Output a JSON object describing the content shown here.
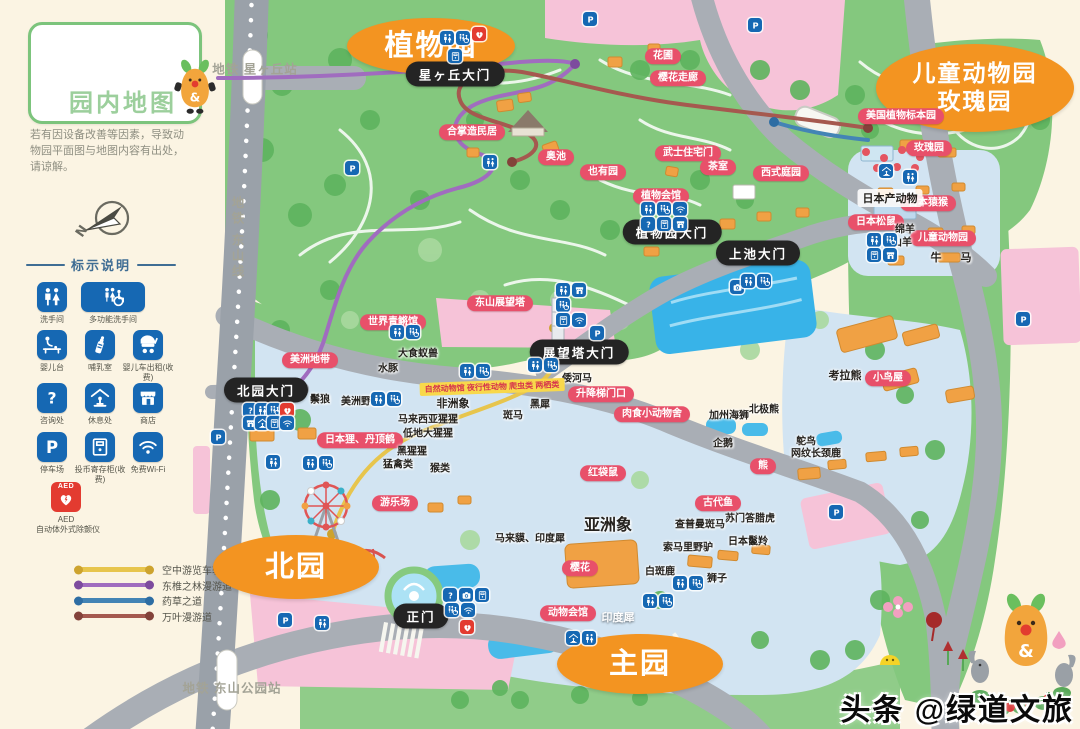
{
  "title_card": {
    "title": "园内地图",
    "mascot_text": "&"
  },
  "disclaimer": "若有因设备改善等因素，导致动物园平面图与地图内容有出处，请谅解。",
  "compass": {
    "letter": "N"
  },
  "legend": {
    "title": "标示说明",
    "items": [
      {
        "icon": "toilet",
        "name": "restroom-icon",
        "label": "洗手间"
      },
      {
        "icon": "acc",
        "name": "accessible-restroom-icon",
        "label": "多功能洗手间",
        "wide": true
      },
      {
        "icon": "baby",
        "name": "baby-changing-icon",
        "label": "婴儿台"
      },
      {
        "icon": "bottle",
        "name": "nursing-room-icon",
        "label": "哺乳室"
      },
      {
        "icon": "stroller",
        "name": "stroller-rental-icon",
        "label": "婴儿车出租(收费)"
      },
      {
        "icon": "q",
        "name": "information-icon",
        "label": "咨询处"
      },
      {
        "icon": "rest",
        "name": "rest-area-icon",
        "label": "休息处"
      },
      {
        "icon": "shop",
        "name": "shop-icon",
        "label": "商店"
      },
      {
        "icon": "park",
        "name": "parking-icon",
        "label": "停车场"
      },
      {
        "icon": "locker",
        "name": "coin-locker-icon",
        "label": "投币寄存柜(收费)"
      },
      {
        "icon": "wifi",
        "name": "free-wifi-icon",
        "label": "免费Wi-Fi"
      }
    ],
    "aed": {
      "label": "AED",
      "caption": "AED",
      "sub": "自动体外式除颤仪"
    }
  },
  "route_legend": [
    {
      "color": "#e7c54d",
      "dot": "#cda32e",
      "label": "空中游览车轨道"
    },
    {
      "color": "#a06cbf",
      "dot": "#7d4b9e",
      "label": "东椎之林漫游道"
    },
    {
      "color": "#4384b5",
      "dot": "#2d6da3",
      "label": "药草之道"
    },
    {
      "color": "#a5594f",
      "dot": "#83423a",
      "label": "万叶漫游道"
    }
  ],
  "map": {
    "stations": [
      {
        "text": "地铁 星ヶ丘站",
        "x": 255,
        "y": 68,
        "vertical": false
      },
      {
        "text": "地铁 东山线",
        "x": 237,
        "y": 238,
        "vertical": true
      },
      {
        "text": "地铁 东山公园站",
        "x": 232,
        "y": 687,
        "vertical": false
      }
    ],
    "area_badges": [
      {
        "text": "植物园",
        "x": 431,
        "y": 46,
        "w": 168,
        "h": 56,
        "fs": 29
      },
      {
        "text": "儿童动物园\n玫瑰园",
        "x": 975,
        "y": 88,
        "w": 198,
        "h": 88,
        "fs": 23
      },
      {
        "text": "北园",
        "x": 296,
        "y": 567,
        "w": 166,
        "h": 64,
        "fs": 29
      },
      {
        "text": "主园",
        "x": 640,
        "y": 664,
        "w": 166,
        "h": 60,
        "fs": 29
      }
    ],
    "gates": [
      {
        "text": "星ヶ丘大门",
        "x": 455,
        "y": 74
      },
      {
        "text": "植物园大门",
        "x": 672,
        "y": 232
      },
      {
        "text": "上池大门",
        "x": 758,
        "y": 253
      },
      {
        "text": "展望塔大门",
        "x": 579,
        "y": 352
      },
      {
        "text": "北园大门",
        "x": 266,
        "y": 390
      },
      {
        "text": "正门",
        "x": 421,
        "y": 616
      }
    ],
    "pills": [
      {
        "text": "花圃",
        "x": 663,
        "y": 56
      },
      {
        "text": "樱花走廊",
        "x": 678,
        "y": 78
      },
      {
        "text": "合掌造民居",
        "x": 472,
        "y": 132
      },
      {
        "text": "奥池",
        "x": 556,
        "y": 157
      },
      {
        "text": "也有园",
        "x": 603,
        "y": 172
      },
      {
        "text": "武士住宅门",
        "x": 688,
        "y": 153
      },
      {
        "text": "茶室",
        "x": 718,
        "y": 167
      },
      {
        "text": "西式庭园",
        "x": 781,
        "y": 173
      },
      {
        "text": "植物会馆",
        "x": 661,
        "y": 196
      },
      {
        "text": "美国植物标本园",
        "x": 901,
        "y": 116
      },
      {
        "text": "玫瑰园",
        "x": 929,
        "y": 148
      },
      {
        "text": "日本猿猴",
        "x": 928,
        "y": 203
      },
      {
        "text": "日本松鼠",
        "x": 876,
        "y": 222
      },
      {
        "text": "儿童动物园",
        "x": 943,
        "y": 238
      },
      {
        "text": "东山展望塔",
        "x": 500,
        "y": 303
      },
      {
        "text": "世界青鳉馆",
        "x": 393,
        "y": 322
      },
      {
        "text": "美洲地带",
        "x": 310,
        "y": 360
      },
      {
        "text": "升降梯门口",
        "x": 601,
        "y": 394
      },
      {
        "text": "肉食小动物舍",
        "x": 652,
        "y": 414
      },
      {
        "text": "日本狸、丹顶鹤",
        "x": 360,
        "y": 440
      },
      {
        "text": "游乐场",
        "x": 395,
        "y": 503
      },
      {
        "text": "红袋鼠",
        "x": 603,
        "y": 473
      },
      {
        "text": "熊",
        "x": 763,
        "y": 466
      },
      {
        "text": "古代鱼",
        "x": 718,
        "y": 503
      },
      {
        "text": "樱花",
        "x": 580,
        "y": 568
      },
      {
        "text": "动物会馆",
        "x": 568,
        "y": 613
      },
      {
        "text": "小鸟屋",
        "x": 888,
        "y": 378
      }
    ],
    "labels": [
      {
        "text": "大食蚁兽",
        "x": 418,
        "y": 352
      },
      {
        "text": "水豚",
        "x": 388,
        "y": 367
      },
      {
        "text": "倭河马",
        "x": 577,
        "y": 377
      },
      {
        "text": "鬃狼",
        "x": 320,
        "y": 398
      },
      {
        "text": "美洲野牛",
        "x": 361,
        "y": 400
      },
      {
        "text": "非洲象",
        "x": 453,
        "y": 403,
        "fs": 11
      },
      {
        "text": "黑犀",
        "x": 540,
        "y": 403
      },
      {
        "text": "斑马",
        "x": 513,
        "y": 414
      },
      {
        "text": "马来西亚猩猩",
        "x": 428,
        "y": 418
      },
      {
        "text": "低地大猩猩",
        "x": 428,
        "y": 432
      },
      {
        "text": "黑猩猩",
        "x": 412,
        "y": 450
      },
      {
        "text": "猛禽类",
        "x": 398,
        "y": 463
      },
      {
        "text": "猴类",
        "x": 440,
        "y": 467
      },
      {
        "text": "日本产动物",
        "x": 890,
        "y": 198,
        "fs": 11,
        "boxed": true
      },
      {
        "text": "绵羊",
        "x": 905,
        "y": 228
      },
      {
        "text": "山羊",
        "x": 902,
        "y": 241
      },
      {
        "text": "牛",
        "x": 936,
        "y": 257,
        "fs": 11
      },
      {
        "text": "马",
        "x": 966,
        "y": 257,
        "fs": 11
      },
      {
        "text": "考拉熊",
        "x": 845,
        "y": 375,
        "fs": 11
      },
      {
        "text": "加州海狮",
        "x": 729,
        "y": 414
      },
      {
        "text": "北极熊",
        "x": 764,
        "y": 408
      },
      {
        "text": "企鹅",
        "x": 723,
        "y": 442
      },
      {
        "text": "鸵鸟",
        "x": 806,
        "y": 440
      },
      {
        "text": "网纹长颈鹿",
        "x": 816,
        "y": 452
      },
      {
        "text": "亚洲象",
        "x": 608,
        "y": 523,
        "fs": 16
      },
      {
        "text": "马来貘、印度犀",
        "x": 530,
        "y": 537
      },
      {
        "text": "苏门答腊虎",
        "x": 750,
        "y": 517
      },
      {
        "text": "查普曼斑马",
        "x": 700,
        "y": 523
      },
      {
        "text": "日本鬣羚",
        "x": 748,
        "y": 540
      },
      {
        "text": "索马里野驴",
        "x": 688,
        "y": 546
      },
      {
        "text": "白斑鹿",
        "x": 660,
        "y": 570
      },
      {
        "text": "狮子",
        "x": 717,
        "y": 577
      },
      {
        "text": "印度犀",
        "x": 618,
        "y": 617,
        "fs": 11,
        "white": true
      }
    ],
    "ribbon": {
      "text": "自然动物馆 夜行性动物 爬虫类 两栖类",
      "x": 492,
      "y": 387
    },
    "icons": [
      {
        "k": "toilet",
        "x": 447,
        "y": 38
      },
      {
        "k": "acc",
        "x": 463,
        "y": 38
      },
      {
        "k": "aed",
        "x": 479,
        "y": 34
      },
      {
        "k": "locker",
        "x": 455,
        "y": 56
      },
      {
        "k": "park",
        "x": 755,
        "y": 25
      },
      {
        "k": "park",
        "x": 590,
        "y": 19
      },
      {
        "k": "park",
        "x": 352,
        "y": 168
      },
      {
        "k": "toilet",
        "x": 490,
        "y": 162
      },
      {
        "k": "toilet",
        "x": 648,
        "y": 209
      },
      {
        "k": "acc",
        "x": 664,
        "y": 209
      },
      {
        "k": "wifi",
        "x": 680,
        "y": 209
      },
      {
        "k": "q",
        "x": 648,
        "y": 224
      },
      {
        "k": "locker",
        "x": 664,
        "y": 224
      },
      {
        "k": "shop",
        "x": 680,
        "y": 224
      },
      {
        "k": "toilet",
        "x": 563,
        "y": 290
      },
      {
        "k": "shop",
        "x": 579,
        "y": 290
      },
      {
        "k": "acc",
        "x": 563,
        "y": 305
      },
      {
        "k": "locker",
        "x": 563,
        "y": 320
      },
      {
        "k": "wifi",
        "x": 579,
        "y": 320
      },
      {
        "k": "park",
        "x": 597,
        "y": 333
      },
      {
        "k": "cam",
        "x": 737,
        "y": 287
      },
      {
        "k": "toilet",
        "x": 748,
        "y": 281
      },
      {
        "k": "acc",
        "x": 764,
        "y": 281
      },
      {
        "k": "rest",
        "x": 886,
        "y": 171
      },
      {
        "k": "toilet",
        "x": 910,
        "y": 177
      },
      {
        "k": "toilet",
        "x": 874,
        "y": 240
      },
      {
        "k": "acc",
        "x": 890,
        "y": 240
      },
      {
        "k": "locker",
        "x": 874,
        "y": 255
      },
      {
        "k": "shop",
        "x": 890,
        "y": 255
      },
      {
        "k": "park",
        "x": 1023,
        "y": 319
      },
      {
        "k": "toilet",
        "x": 397,
        "y": 332
      },
      {
        "k": "acc",
        "x": 413,
        "y": 332
      },
      {
        "k": "toilet",
        "x": 535,
        "y": 365
      },
      {
        "k": "acc",
        "x": 551,
        "y": 365
      },
      {
        "k": "toilet",
        "x": 467,
        "y": 371
      },
      {
        "k": "acc",
        "x": 483,
        "y": 371
      },
      {
        "k": "toilet",
        "x": 378,
        "y": 399
      },
      {
        "k": "acc",
        "x": 394,
        "y": 399
      },
      {
        "k": "q",
        "x": 250,
        "y": 410
      },
      {
        "k": "toilet",
        "x": 262,
        "y": 410
      },
      {
        "k": "acc",
        "x": 274,
        "y": 410
      },
      {
        "k": "aed",
        "x": 287,
        "y": 410
      },
      {
        "k": "shop",
        "x": 250,
        "y": 423
      },
      {
        "k": "rest",
        "x": 262,
        "y": 423
      },
      {
        "k": "locker",
        "x": 274,
        "y": 423
      },
      {
        "k": "wifi",
        "x": 287,
        "y": 423
      },
      {
        "k": "park",
        "x": 218,
        "y": 437
      },
      {
        "k": "toilet",
        "x": 273,
        "y": 462
      },
      {
        "k": "toilet",
        "x": 310,
        "y": 463
      },
      {
        "k": "acc",
        "x": 326,
        "y": 463
      },
      {
        "k": "park",
        "x": 285,
        "y": 620
      },
      {
        "k": "toilet",
        "x": 322,
        "y": 623
      },
      {
        "k": "q",
        "x": 450,
        "y": 595
      },
      {
        "k": "cam",
        "x": 466,
        "y": 595
      },
      {
        "k": "locker",
        "x": 482,
        "y": 595
      },
      {
        "k": "acc",
        "x": 452,
        "y": 610
      },
      {
        "k": "wifi",
        "x": 468,
        "y": 610
      },
      {
        "k": "aed",
        "x": 467,
        "y": 627
      },
      {
        "k": "rest",
        "x": 573,
        "y": 638
      },
      {
        "k": "toilet",
        "x": 589,
        "y": 638
      },
      {
        "k": "toilet",
        "x": 650,
        "y": 601
      },
      {
        "k": "acc",
        "x": 666,
        "y": 601
      },
      {
        "k": "toilet",
        "x": 680,
        "y": 583
      },
      {
        "k": "acc",
        "x": 696,
        "y": 583
      },
      {
        "k": "park",
        "x": 836,
        "y": 512
      }
    ]
  },
  "watermark": "头条 @绿道文旅"
}
